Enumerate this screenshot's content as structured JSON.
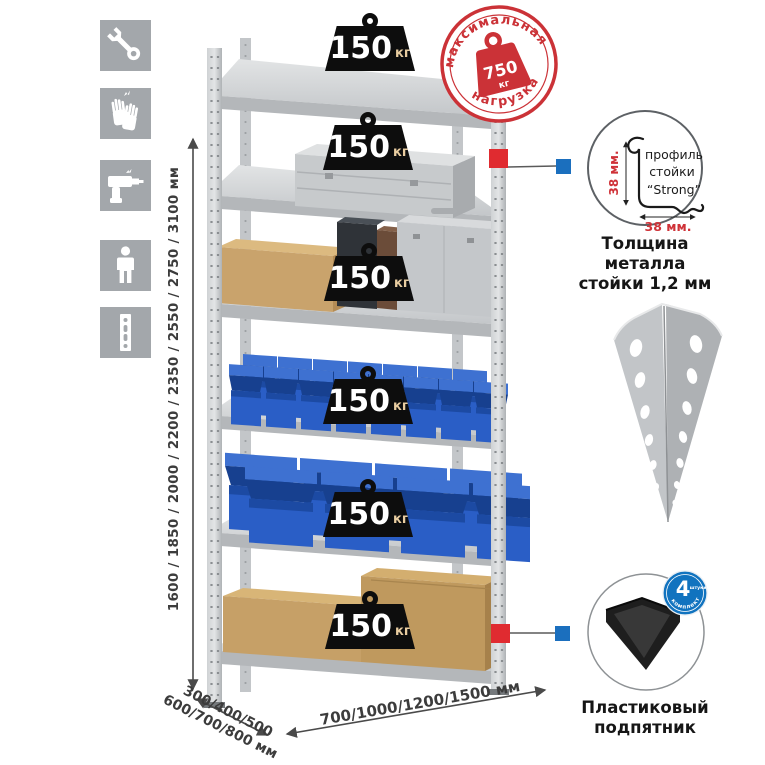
{
  "sidebar": {
    "icons": [
      {
        "name": "wrench-icon"
      },
      {
        "name": "gloves-icon"
      },
      {
        "name": "drill-icon"
      },
      {
        "name": "person-height-icon"
      },
      {
        "name": "perforated-post-icon"
      }
    ]
  },
  "rack": {
    "shelf_count": 6,
    "shelf_load_value": "150",
    "shelf_load_unit": "кг",
    "height_options": "1600 / 1850 / 2000 / 2200 / 2350 / 2550 / 2750 / 3100 мм",
    "depth_options_line1": "300/400/500",
    "depth_options_line2": "600/700/800 мм",
    "width_options": "700/1000/1200/1500 мм"
  },
  "max_load_stamp": {
    "arc_top": "максимальная",
    "arc_bottom": "нагрузка",
    "value": "750",
    "unit": "кг"
  },
  "profile_detail": {
    "label_line1": "профиль",
    "label_line2": "стойки",
    "label_line3": "“Strong”",
    "dim_vertical": "38 мм.",
    "dim_horizontal": "38 мм.",
    "caption_line1": "Толщина металла",
    "caption_line2": "стойки 1,2 мм"
  },
  "foot_detail": {
    "badge_value": "4",
    "badge_unit": "штуки",
    "badge_arc": "в комплекте",
    "caption_line1": "Пластиковый",
    "caption_line2": "подпятник"
  },
  "colors": {
    "stamp_red": "#cb3237",
    "marker_red": "#e02b30",
    "marker_blue": "#1b6fbe",
    "bin_blue": "#2a5ec6",
    "metal_gray": "#c6c9cc",
    "icon_tile_gray": "#a3a7ab"
  }
}
